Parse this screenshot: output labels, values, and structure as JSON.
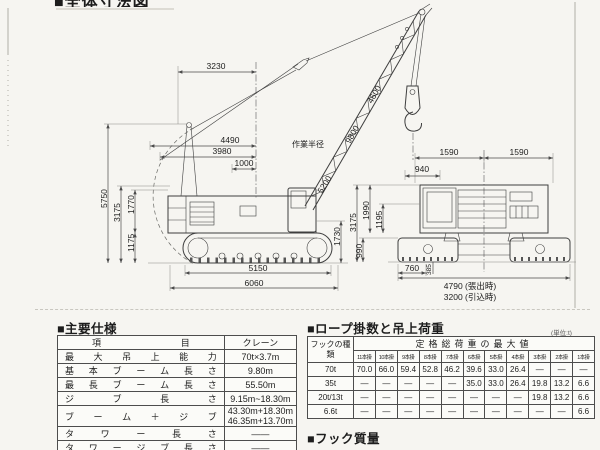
{
  "page": {
    "clipped_title": "■全体寸法図"
  },
  "drawing": {
    "side_view": {
      "dims": {
        "top_width": "3230",
        "upper_a": "4490",
        "upper_b": "3980",
        "upper_c": "1000",
        "boom_upper": "4600",
        "boom_mid": "9800",
        "boom_lower": "5200",
        "height_total": "5750",
        "height_body": "3175",
        "height_upper": "1770",
        "height_track": "1175",
        "cab_height": "1730",
        "track_length": "5150",
        "overall_length": "6060",
        "working_radius": "作業半径"
      }
    },
    "rear_view": {
      "dims": {
        "gauge_left": "1590",
        "gauge_right": "1590",
        "drum": "940",
        "height_total": "3175",
        "height_upper": "1990",
        "height_mid": "1195",
        "height_track": "990",
        "shoe_width": "760",
        "clearance": "385",
        "width_extended": "4790 (張出時)",
        "width_retracted": "3200 (引込時)"
      }
    }
  },
  "spec_table": {
    "heading": "■主要仕様",
    "col_item": "項 目",
    "col_value": "クレーン",
    "rows": [
      {
        "label": "最 大 吊 上 能 力",
        "value": "70t×3.7m"
      },
      {
        "label": "基 本 ブ ー ム 長 さ",
        "value": "9.80m"
      },
      {
        "label": "最 長 ブ ー ム 長 さ",
        "value": "55.50m"
      },
      {
        "label": "ジ ブ 長 さ",
        "value": "9.15m~18.30m"
      },
      {
        "label": "ブ ー ム ＋ ジ ブ",
        "value1": "43.30m+18.30m",
        "value2": "46.35m+13.70m"
      },
      {
        "label": "タ ワ ー 長 さ",
        "value": "――"
      },
      {
        "label": "タ ワ ー ジ ブ 長 さ",
        "value": "――"
      }
    ]
  },
  "load_table": {
    "heading": "■ロープ掛数と吊上荷重",
    "unit_note": "(単位:t)",
    "hook_col_header": "フックの種類",
    "max_header": "定格総荷重の最大値",
    "fall_headers": [
      "11本掛",
      "10本掛",
      "9本掛",
      "8本掛",
      "7本掛",
      "6本掛",
      "5本掛",
      "4本掛",
      "3本掛",
      "2本掛",
      "1本掛"
    ],
    "rows": [
      {
        "hook": "70t",
        "values": [
          "70.0",
          "66.0",
          "59.4",
          "52.8",
          "46.2",
          "39.6",
          "33.0",
          "26.4",
          "—",
          "—",
          "—"
        ]
      },
      {
        "hook": "35t",
        "values": [
          "—",
          "—",
          "—",
          "—",
          "—",
          "35.0",
          "33.0",
          "26.4",
          "19.8",
          "13.2",
          "6.6"
        ]
      },
      {
        "hook": "20t/13t",
        "values": [
          "—",
          "—",
          "—",
          "—",
          "—",
          "—",
          "—",
          "—",
          "19.8",
          "13.2",
          "6.6"
        ]
      },
      {
        "hook": "6.6t",
        "values": [
          "—",
          "—",
          "—",
          "—",
          "—",
          "—",
          "—",
          "—",
          "—",
          "—",
          "6.6"
        ]
      }
    ]
  },
  "hook_mass": {
    "heading": "■フック質量"
  }
}
